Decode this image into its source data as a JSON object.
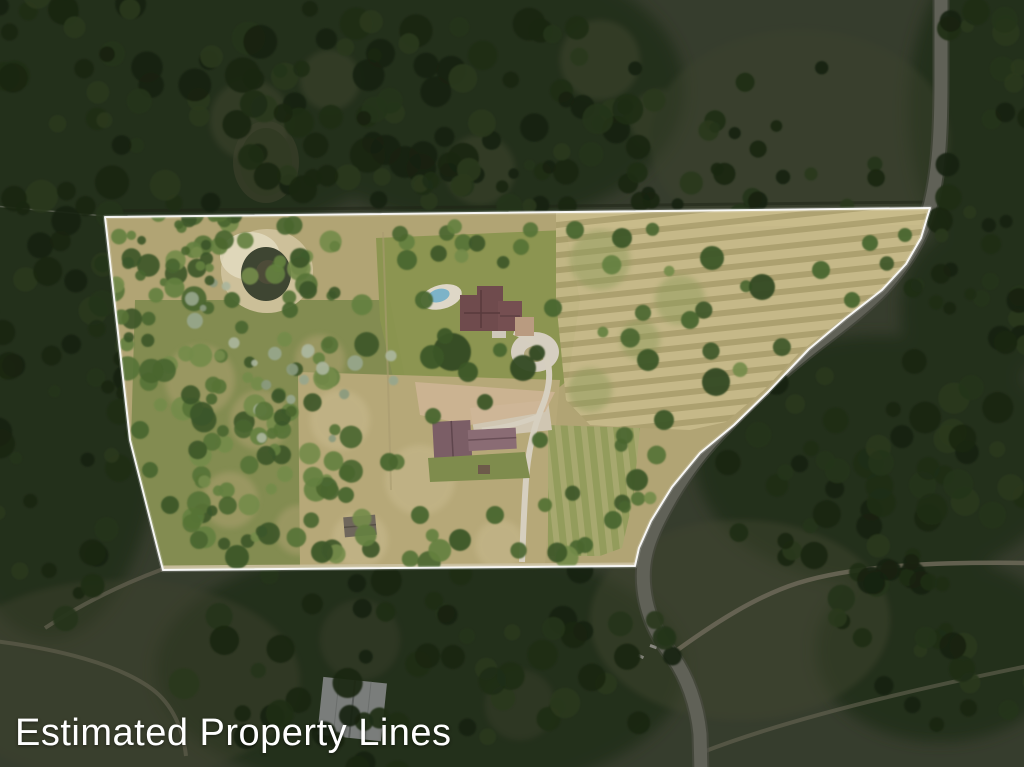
{
  "page": {
    "title": "Estimated Property Lines"
  },
  "annotation": {
    "label": "Estimated Property Lines",
    "color": "#ffffff"
  },
  "scene": {
    "type": "aerial-photograph",
    "canvas": {
      "width": 1024,
      "height": 767
    },
    "parcel": {
      "points": "105,217 930,208 921,238 906,264 882,290 846,318 809,349 769,391 734,425 700,453 672,487 651,521 639,548 635,566 163,570 130,440",
      "stroke": "#ffffff",
      "features": [
        "pond",
        "house",
        "swimming-pool",
        "driveway",
        "barn",
        "shed",
        "hay-field",
        "pasture",
        "woods"
      ]
    },
    "road": {
      "d": "M941,-6 L941,80 C941,130 939,175 929,210 C920,240 906,262 883,288 C859,313 828,334 801,356 C772,379 743,407 717,435 C693,461 673,491 659,519 C647,543 641,563 644,589 C647,617 659,639 673,657 C687,677 697,704 700,734 L701,772",
      "color": "#a0a094"
    },
    "trails": {
      "ne": {
        "d": "M676,651 C716,622 757,596 798,583 C858,564 948,562 1028,563"
      },
      "se": {
        "d": "M703,752 C780,722 900,692 1028,666"
      },
      "sw": {
        "d": "M-6,641 C58,649 118,664 152,689 C172,704 183,728 186,756"
      },
      "corner": {
        "d": "M163,569 C120,585 80,605 45,628"
      },
      "bottom_track": {
        "d": "M163,568 L636,565"
      },
      "driveway_main": {
        "d": "M514,332 C530,338 542,346 547,360 C552,376 548,394 540,412 C534,428 528,452 526,480 C524,508 523,538 522,562"
      },
      "driveway_barn": {
        "d": "M539,416 C520,424 500,428 482,430"
      },
      "pool_walk": {
        "d": "M462,300 C470,302 478,306 484,312"
      },
      "fence_left": {
        "d": "M-5,206 L105,216"
      },
      "fence_top_dark": {
        "d": "M100,211 L930,202"
      },
      "fence_inner_1": {
        "d": "M383,232 L388,380"
      },
      "fence_inner_2": {
        "d": "M388,380 L391,490"
      }
    },
    "palettes": {
      "outside": [
        "#243818",
        "#2d441f",
        "#365026",
        "#41592d",
        "#1f3014"
      ],
      "inside": [
        "#3c5629",
        "#49652f",
        "#577336",
        "#648040",
        "#748b4a"
      ],
      "sage": [
        "#97a68c",
        "#aab59c",
        "#8a9a7e"
      ]
    },
    "tree_clusters": [
      {
        "layer": "out",
        "cx": 160,
        "cy": 90,
        "rx": 240,
        "ry": 130,
        "n": 70,
        "rmin": 7,
        "rmax": 18,
        "seed": 1,
        "pal": "outside"
      },
      {
        "layer": "out",
        "cx": 470,
        "cy": 95,
        "rx": 190,
        "ry": 120,
        "n": 55,
        "rmin": 7,
        "rmax": 17,
        "seed": 2,
        "pal": "outside"
      },
      {
        "layer": "out",
        "cx": 55,
        "cy": 400,
        "rx": 95,
        "ry": 230,
        "n": 55,
        "rmin": 6,
        "rmax": 15,
        "seed": 3,
        "pal": "outside"
      },
      {
        "layer": "out",
        "cx": 1000,
        "cy": 115,
        "rx": 85,
        "ry": 150,
        "n": 30,
        "rmin": 6,
        "rmax": 14,
        "seed": 4,
        "pal": "outside"
      },
      {
        "layer": "out",
        "cx": 880,
        "cy": 470,
        "rx": 170,
        "ry": 115,
        "n": 55,
        "rmin": 7,
        "rmax": 16,
        "seed": 5,
        "pal": "outside"
      },
      {
        "layer": "out",
        "cx": 430,
        "cy": 665,
        "rx": 250,
        "ry": 120,
        "n": 65,
        "rmin": 7,
        "rmax": 16,
        "seed": 6,
        "pal": "outside"
      },
      {
        "layer": "out",
        "cx": 935,
        "cy": 645,
        "rx": 115,
        "ry": 85,
        "n": 28,
        "rmin": 6,
        "rmax": 14,
        "seed": 7,
        "pal": "outside"
      },
      {
        "layer": "out",
        "cx": 790,
        "cy": 150,
        "rx": 130,
        "ry": 85,
        "n": 14,
        "rmin": 5,
        "rmax": 12,
        "seed": 8,
        "pal": "outside"
      },
      {
        "layer": "out",
        "cx": 590,
        "cy": 185,
        "rx": 300,
        "ry": 22,
        "n": 30,
        "rmin": 5,
        "rmax": 12,
        "seed": 9,
        "pal": "outside"
      },
      {
        "layer": "out",
        "cx": 980,
        "cy": 300,
        "rx": 70,
        "ry": 90,
        "n": 18,
        "rmin": 6,
        "rmax": 13,
        "seed": 19,
        "pal": "outside"
      },
      {
        "layer": "in",
        "cx": 235,
        "cy": 320,
        "rx": 135,
        "ry": 115,
        "n": 80,
        "rmin": 5,
        "rmax": 13,
        "seed": 10,
        "pal": "inside"
      },
      {
        "layer": "in",
        "cx": 285,
        "cy": 480,
        "rx": 115,
        "ry": 85,
        "n": 45,
        "rmin": 5,
        "rmax": 12,
        "seed": 11,
        "pal": "inside"
      },
      {
        "layer": "in",
        "cx": 300,
        "cy": 340,
        "rx": 120,
        "ry": 110,
        "n": 22,
        "rmin": 3,
        "rmax": 8,
        "seed": 12,
        "pal": "sage"
      },
      {
        "layer": "in",
        "cx": 180,
        "cy": 250,
        "rx": 70,
        "ry": 40,
        "n": 18,
        "rmin": 4,
        "rmax": 10,
        "seed": 13,
        "pal": "inside"
      },
      {
        "layer": "in",
        "cx": 745,
        "cy": 295,
        "rx": 165,
        "ry": 85,
        "n": 13,
        "rmin": 5,
        "rmax": 11,
        "seed": 14,
        "pal": "inside"
      },
      {
        "layer": "in",
        "cx": 400,
        "cy": 545,
        "rx": 210,
        "ry": 22,
        "n": 14,
        "rmin": 6,
        "rmax": 12,
        "seed": 15,
        "pal": "inside"
      },
      {
        "layer": "in",
        "cx": 470,
        "cy": 240,
        "rx": 90,
        "ry": 25,
        "n": 10,
        "rmin": 4,
        "rmax": 9,
        "seed": 16,
        "pal": "inside"
      },
      {
        "layer": "in",
        "cx": 330,
        "cy": 430,
        "rx": 90,
        "ry": 70,
        "n": 8,
        "rmin": 6,
        "rmax": 12,
        "seed": 17,
        "pal": "inside"
      },
      {
        "layer": "in",
        "cx": 610,
        "cy": 470,
        "rx": 60,
        "ry": 50,
        "n": 8,
        "rmin": 5,
        "rmax": 10,
        "seed": 18,
        "pal": "inside"
      }
    ],
    "trees": [
      {
        "x": 452,
        "y": 352,
        "r": 19,
        "c": "#314a21"
      },
      {
        "x": 432,
        "y": 357,
        "r": 12,
        "c": "#3c5629"
      },
      {
        "x": 468,
        "y": 372,
        "r": 10,
        "c": "#3c5629"
      },
      {
        "x": 523,
        "y": 368,
        "r": 13,
        "c": "#314a21"
      },
      {
        "x": 553,
        "y": 308,
        "r": 9,
        "c": "#49652f"
      },
      {
        "x": 424,
        "y": 300,
        "r": 9,
        "c": "#49652f"
      },
      {
        "x": 407,
        "y": 260,
        "r": 10,
        "c": "#49652f"
      },
      {
        "x": 521,
        "y": 247,
        "r": 8,
        "c": "#577336"
      },
      {
        "x": 575,
        "y": 230,
        "r": 9,
        "c": "#49652f"
      },
      {
        "x": 622,
        "y": 238,
        "r": 10,
        "c": "#3c5629"
      },
      {
        "x": 712,
        "y": 258,
        "r": 12,
        "c": "#3c5629"
      },
      {
        "x": 762,
        "y": 287,
        "r": 13,
        "c": "#314a21"
      },
      {
        "x": 821,
        "y": 270,
        "r": 9,
        "c": "#49652f"
      },
      {
        "x": 870,
        "y": 243,
        "r": 8,
        "c": "#49652f"
      },
      {
        "x": 690,
        "y": 320,
        "r": 9,
        "c": "#49652f"
      },
      {
        "x": 648,
        "y": 360,
        "r": 11,
        "c": "#3c5629"
      },
      {
        "x": 716,
        "y": 382,
        "r": 14,
        "c": "#314a21"
      },
      {
        "x": 664,
        "y": 420,
        "r": 10,
        "c": "#3c5629"
      },
      {
        "x": 637,
        "y": 480,
        "r": 11,
        "c": "#3c5629"
      },
      {
        "x": 613,
        "y": 520,
        "r": 9,
        "c": "#49652f"
      },
      {
        "x": 585,
        "y": 545,
        "r": 8,
        "c": "#49652f"
      },
      {
        "x": 545,
        "y": 505,
        "r": 7,
        "c": "#577336"
      },
      {
        "x": 495,
        "y": 515,
        "r": 9,
        "c": "#49652f"
      },
      {
        "x": 460,
        "y": 540,
        "r": 11,
        "c": "#3c5629"
      },
      {
        "x": 420,
        "y": 515,
        "r": 9,
        "c": "#49652f"
      },
      {
        "x": 389,
        "y": 462,
        "r": 9,
        "c": "#49652f"
      },
      {
        "x": 346,
        "y": 495,
        "r": 8,
        "c": "#49652f"
      },
      {
        "x": 322,
        "y": 552,
        "r": 11,
        "c": "#3c5629"
      },
      {
        "x": 237,
        "y": 557,
        "r": 12,
        "c": "#3c5629"
      },
      {
        "x": 199,
        "y": 540,
        "r": 9,
        "c": "#49652f"
      },
      {
        "x": 433,
        "y": 416,
        "r": 8,
        "c": "#49652f"
      },
      {
        "x": 540,
        "y": 440,
        "r": 8,
        "c": "#49652f"
      },
      {
        "x": 485,
        "y": 402,
        "r": 8,
        "c": "#3c5629"
      },
      {
        "x": 537,
        "y": 353,
        "r": 8,
        "c": "#314a21"
      },
      {
        "x": 445,
        "y": 336,
        "r": 8,
        "c": "#3c5629"
      },
      {
        "x": 500,
        "y": 350,
        "r": 7,
        "c": "#49652f"
      },
      {
        "x": 300,
        "y": 258,
        "r": 10,
        "c": "#3c5629"
      },
      {
        "x": 308,
        "y": 290,
        "r": 9,
        "c": "#3c5629"
      },
      {
        "x": 290,
        "y": 310,
        "r": 8,
        "c": "#49652f"
      },
      {
        "x": 232,
        "y": 300,
        "r": 8,
        "c": "#49652f"
      },
      {
        "x": 905,
        "y": 235,
        "r": 7,
        "c": "#49652f"
      },
      {
        "x": 852,
        "y": 300,
        "r": 8,
        "c": "#49652f"
      },
      {
        "x": 140,
        "y": 430,
        "r": 9,
        "c": "#49652f"
      },
      {
        "x": 150,
        "y": 470,
        "r": 8,
        "c": "#49652f"
      },
      {
        "x": 170,
        "y": 505,
        "r": 9,
        "c": "#3c5629"
      }
    ],
    "overlay_dim": "rgba(13,17,9,0.44)"
  }
}
